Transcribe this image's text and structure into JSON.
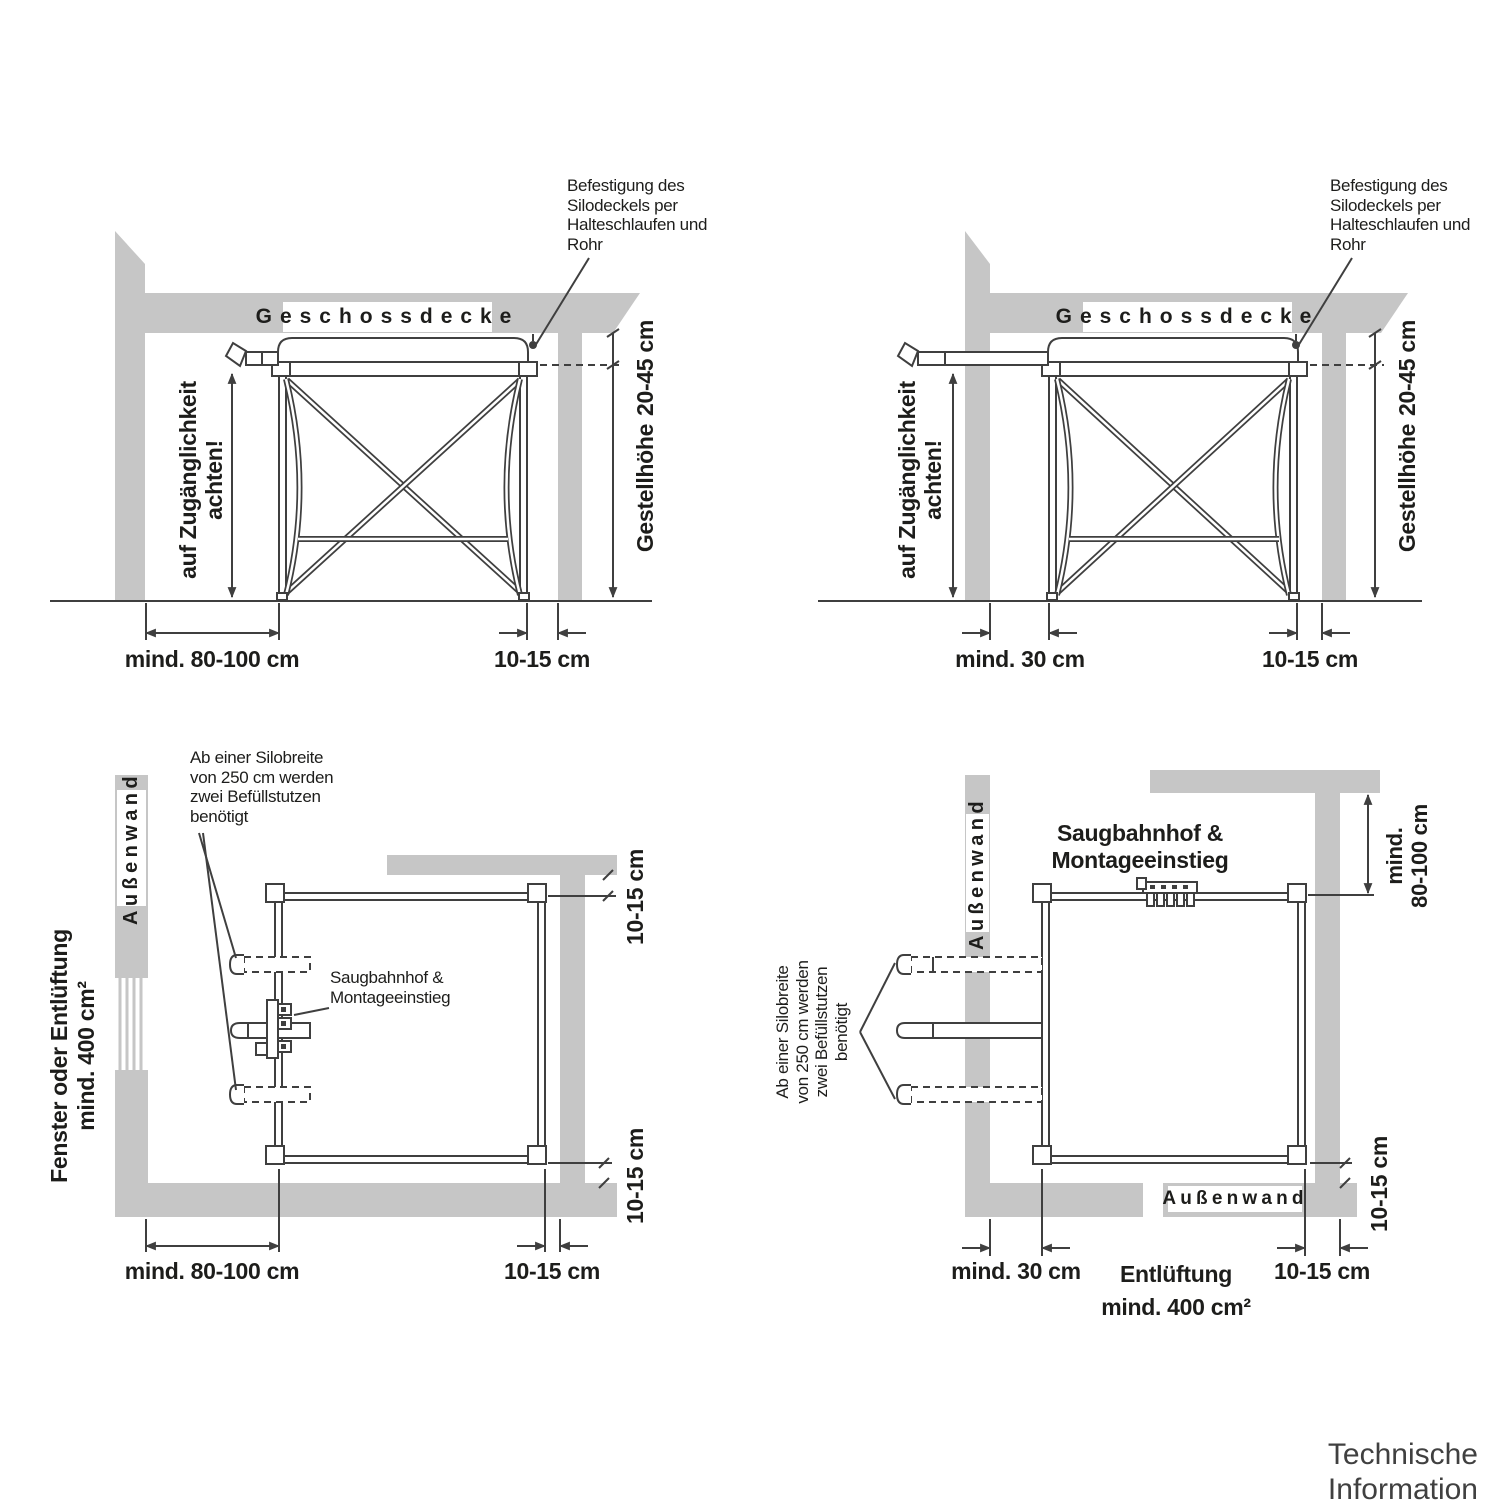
{
  "colors": {
    "wall": "#c6c6c6",
    "line": "#3f3f3f",
    "text": "#1d1d1b"
  },
  "footer": {
    "title": "Technische Information"
  },
  "top_left": {
    "fastening_note": "Befestigung des\nSilodeckels per\nHalteschlaufen und\nRohr",
    "ceiling_label": "Geschossdecke",
    "access_note": "auf Zugänglichkeit achten!",
    "gap_top": "20-45 cm",
    "frame_height": "Gestellhöhe",
    "clearance_left": "mind. 80-100 cm",
    "clearance_right": "10-15 cm"
  },
  "top_right": {
    "fastening_note": "Befestigung des\nSilodeckels per\nHalteschlaufen und\nRohr",
    "ceiling_label": "Geschossdecke",
    "access_note": "auf Zugänglichkeit achten!",
    "gap_top": "20-45 cm",
    "frame_height": "Gestellhöhe",
    "clearance_left": "mind. 30 cm",
    "clearance_right": "10-15 cm"
  },
  "bottom_left": {
    "silo_width_note": "Ab einer Silobreite\nvon 250 cm werden\nzwei Befüllstutzen\nbenötigt",
    "outer_wall_label": "Außenwand",
    "window_note": "Fenster oder Entlüftung\nmind. 400 cm²",
    "port_label": "Saugbahnhof &\nMontageeinstieg",
    "gap_top_right": "10-15 cm",
    "gap_bottom_right_side": "10-15 cm",
    "clearance_bottom": "mind. 80-100 cm",
    "gap_bottom_right": "10-15 cm"
  },
  "bottom_right": {
    "silo_width_note": "Ab einer Silobreite\nvon 250 cm werden\nzwei Befüllstutzen\nbenötigt",
    "outer_wall_label_left": "Außenwand",
    "outer_wall_label_bottom": "Außenwand",
    "port_label": "Saugbahnhof &\nMontageeinstieg",
    "access_top": "mind.\n80-100 cm",
    "gap_right_side": "10-15 cm",
    "clearance_bottom_left": "mind. 30 cm",
    "vent_note": "Entlüftung\nmind. 400 cm²",
    "gap_bottom_right": "10-15 cm"
  }
}
